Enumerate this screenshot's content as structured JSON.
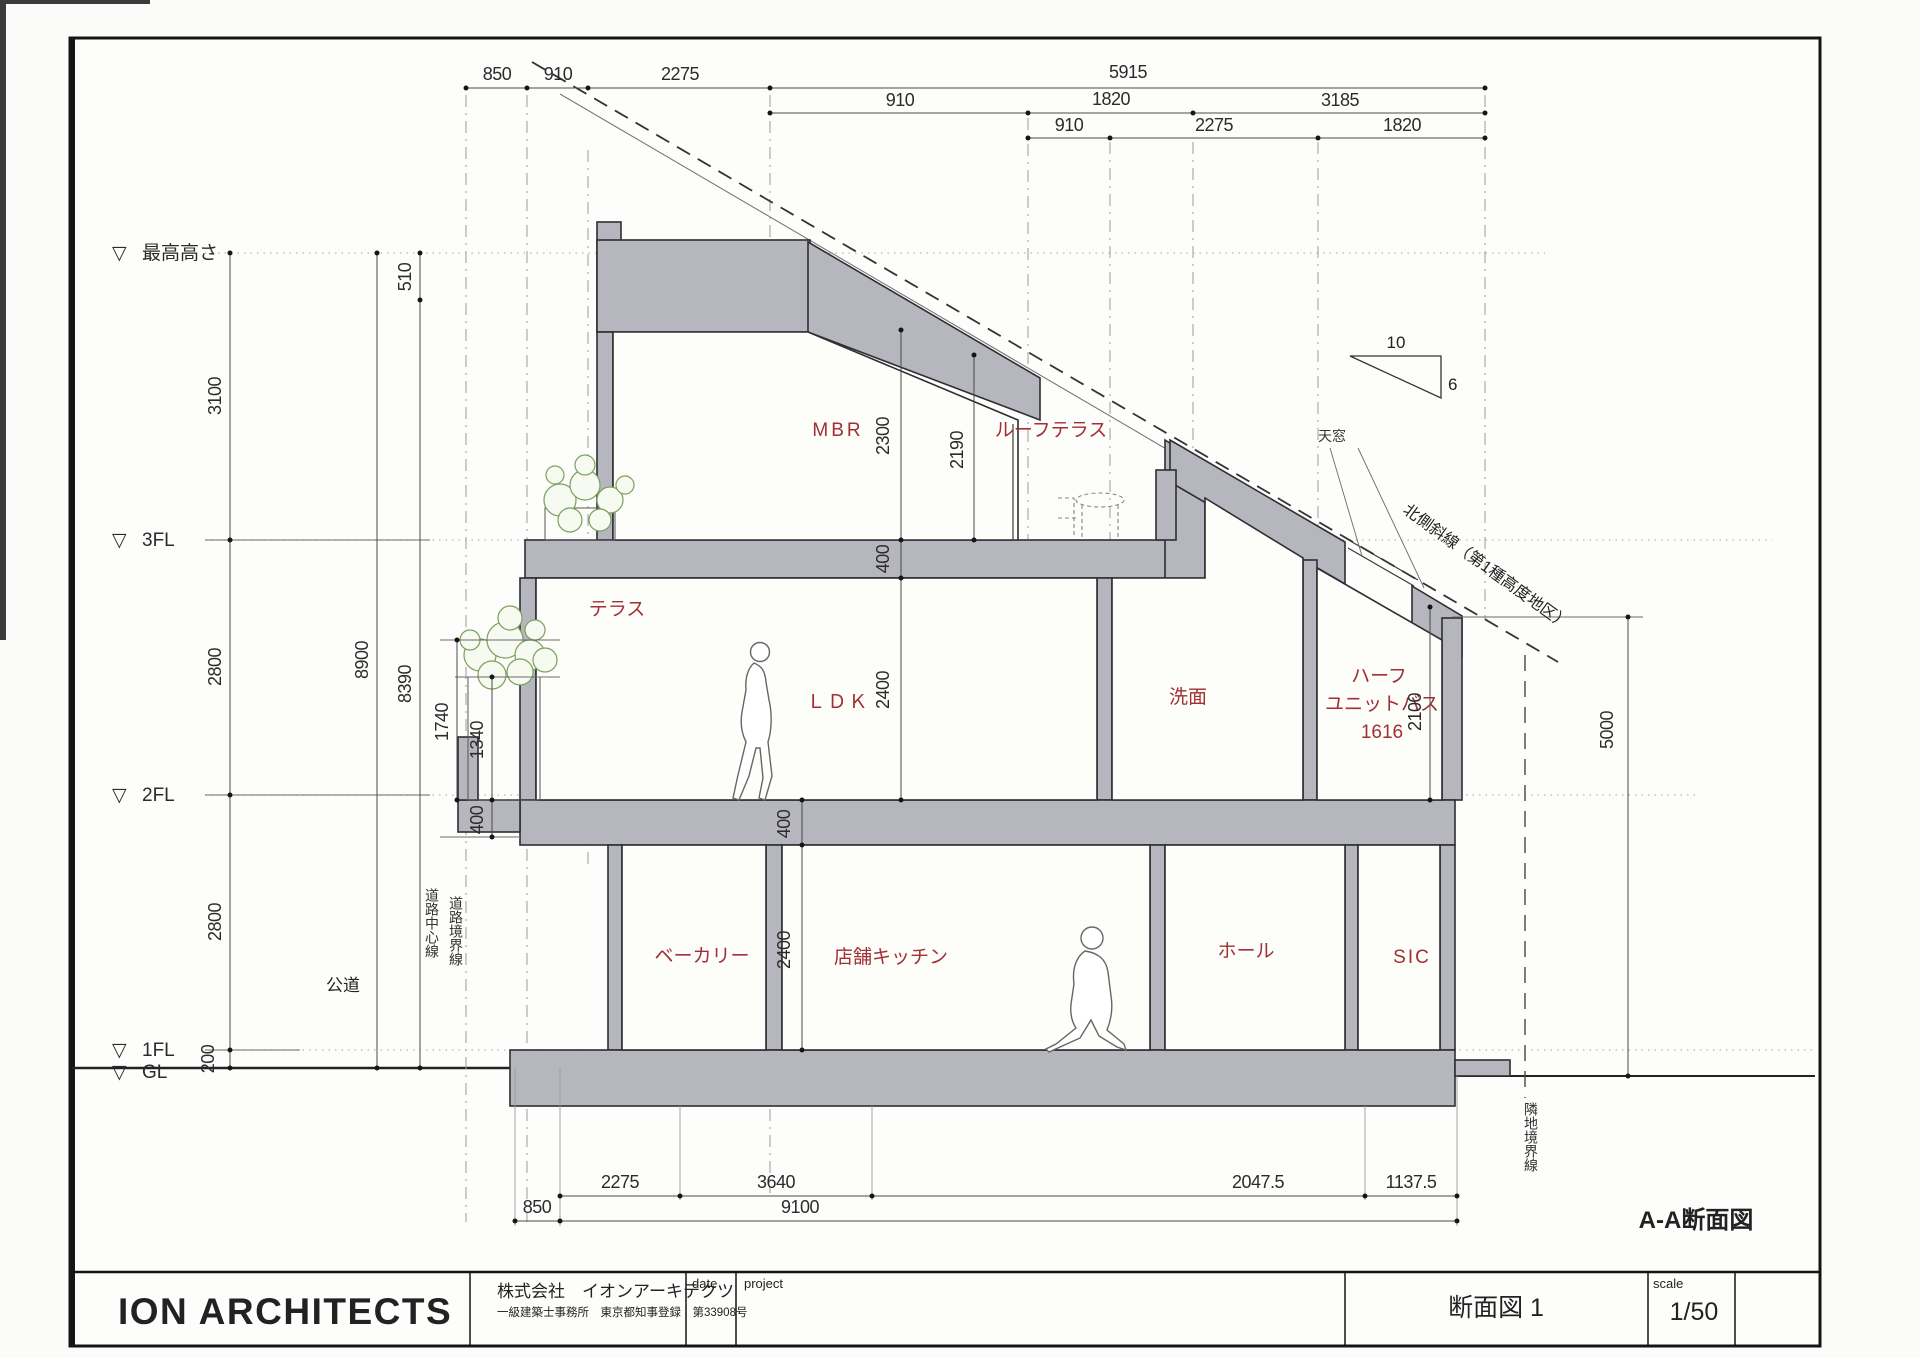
{
  "colors": {
    "accent_red": "#a12f35",
    "concrete_gray": "#b6b6be",
    "leaf_green": "#7aa05c"
  },
  "levels": {
    "marker": "▽",
    "max_height": "最高高さ",
    "f3": "3FL",
    "f2": "2FL",
    "f1": "1FL",
    "gl": "GL"
  },
  "rooms": {
    "mbr": "MBR",
    "roof_terrace": "ルーフテラス",
    "terrace": "テラス",
    "ldk": "ＬＤＫ",
    "washroom": "洗面",
    "bath_line1": "ハーフ",
    "bath_line2": "ユニットバス",
    "bath_size": "1616",
    "bakery": "ベーカリー",
    "shop_kitchen": "店舗キッチン",
    "hall": "ホール",
    "sic": "SIC"
  },
  "dims": {
    "top_row1": [
      "850",
      "910",
      "2275",
      "5915"
    ],
    "top_row2": [
      "910",
      "1820",
      "3185"
    ],
    "top_row3": [
      "910",
      "2275",
      "1820"
    ],
    "left_top": "510",
    "left_chain": [
      "3100",
      "2800",
      "2800",
      "200"
    ],
    "left_total": "8900",
    "left_sub": "8390",
    "terrace_chain": [
      "1740",
      "1340",
      "400"
    ],
    "mbr_heights": [
      "2300",
      "2190"
    ],
    "slab3f": "400",
    "ldk_height": "2400",
    "slab2f": "400",
    "f1_height": "2400",
    "bath_height": "2100",
    "right_height": "5000",
    "bottom_row1": [
      "2275",
      "3640",
      "2047.5",
      "1137.5"
    ],
    "bottom_row2": [
      "850",
      "9100"
    ]
  },
  "site": {
    "road": "公道",
    "road_center": "道路中心線",
    "road_boundary": "道路境界線",
    "neighbor_boundary": "隣地境界線",
    "north_slant": "北側斜線（第1種高度地区）",
    "skylight": "天窓",
    "slope_run": "10",
    "slope_rise": "6"
  },
  "drawing_title": "A-A断面図",
  "title_block": {
    "logo": "ION ARCHITECTS",
    "company": "株式会社　イオンアーキテクツ",
    "license": "一級建築士事務所　東京都知事登録　第33908号",
    "date_label": "date",
    "project_label": "project",
    "sheet_name": "断面図 1",
    "scale_label": "scale",
    "scale_value": "1/50"
  }
}
